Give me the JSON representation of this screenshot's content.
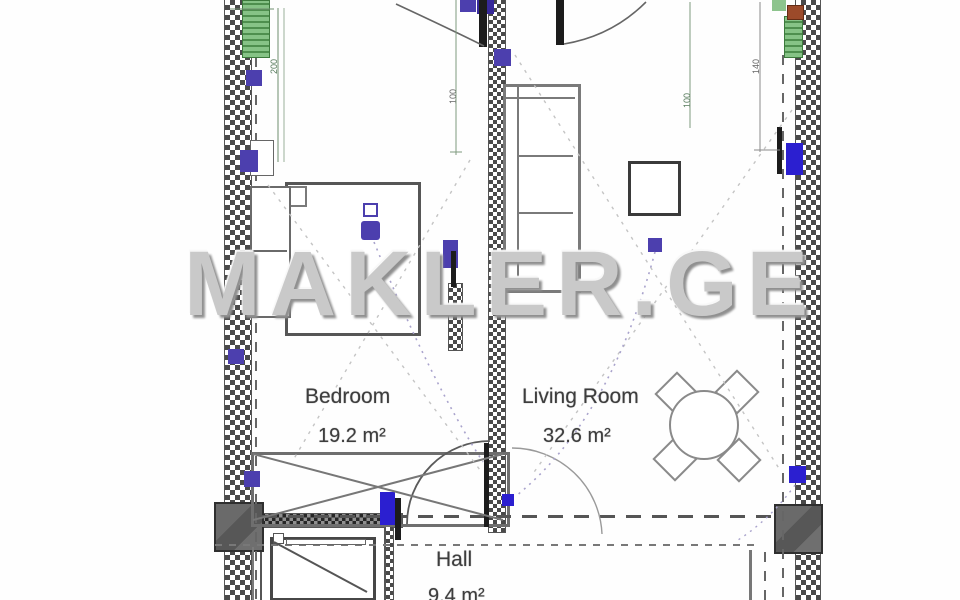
{
  "watermark": {
    "text": "MAKLER.GE"
  },
  "rooms": [
    {
      "name": "Bedroom",
      "area": "19.2 m²"
    },
    {
      "name": "Living Room",
      "area": "32.6 m²"
    },
    {
      "name": "Hall",
      "area": "9.4 m²"
    }
  ],
  "dimensions": {
    "left_wall": "200",
    "bedroom_top": "100",
    "living_top": "100",
    "right_wall": "140"
  },
  "colors": {
    "wall_hatch": "#4a4a4a",
    "socket": "#4c3fae",
    "window": "#2b1fd0",
    "radiator": "#7fbf7f",
    "valve": "#9c4a2a",
    "watermark": "#c9c9c9",
    "dashed_line": "#666666"
  }
}
